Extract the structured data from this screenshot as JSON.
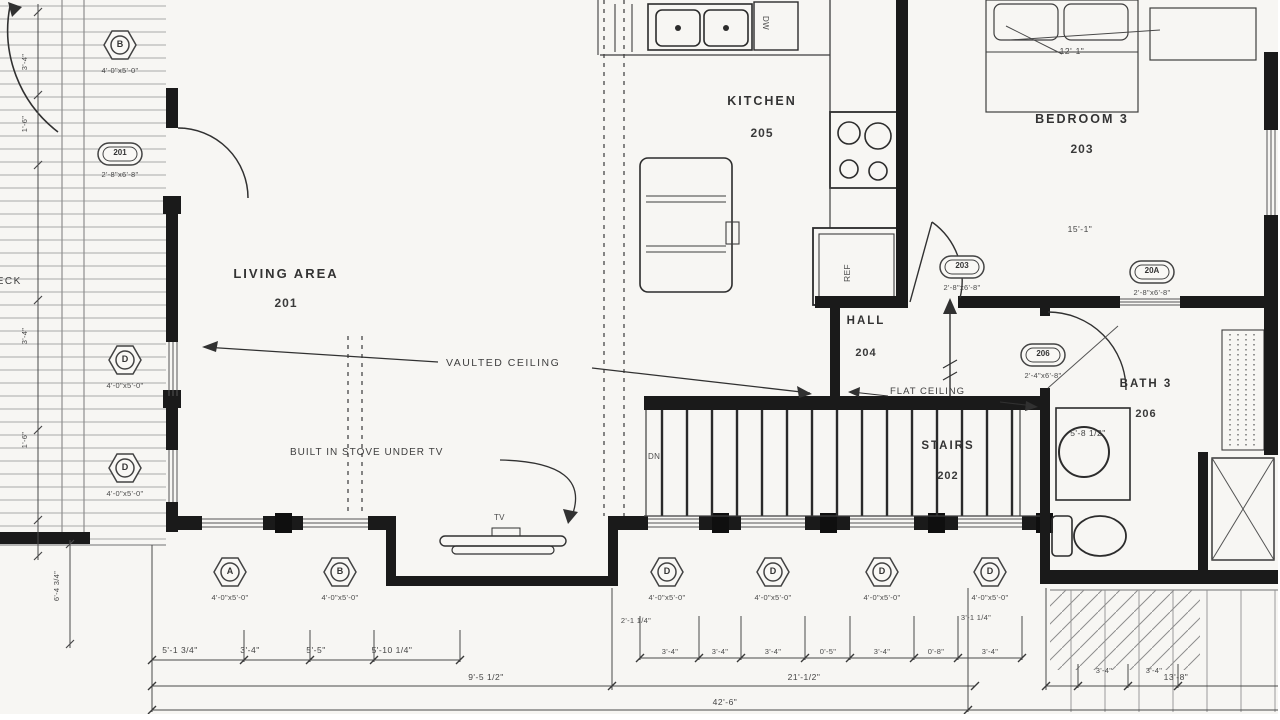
{
  "colors": {
    "paper": "#f7f6f3",
    "wall": "#1c1c1c",
    "line_dark": "#3f3f3f",
    "line_light": "#9a9a9a",
    "text": "#3a3a3a"
  },
  "rooms": {
    "living": {
      "name": "LIVING AREA",
      "number": "201"
    },
    "kitchen": {
      "name": "KITCHEN",
      "number": "205"
    },
    "bedroom3": {
      "name": "BEDROOM 3",
      "number": "203"
    },
    "hall": {
      "name": "HALL",
      "number": "204"
    },
    "stairs": {
      "name": "STAIRS",
      "number": "202"
    },
    "bath3": {
      "name": "BATH 3",
      "number": "206"
    }
  },
  "annotations": {
    "vaulted": "VAULTED CEILING",
    "flat": "FLAT CEILING",
    "built_in": "BUILT IN STOVE UNDER TV",
    "tv": "TV",
    "dw": "DW",
    "ref": "REF",
    "dn": "DN",
    "deck": "DECK"
  },
  "window_tags": [
    {
      "letter": "B",
      "size": "4'-0\"x5'-0\""
    },
    {
      "letter": "D",
      "size": "4'-0\"x5'-0\""
    },
    {
      "letter": "D",
      "size": "4'-0\"x5'-0\""
    },
    {
      "letter": "A",
      "size": "4'-0\"x5'-0\""
    },
    {
      "letter": "B",
      "size": "4'-0\"x5'-0\""
    },
    {
      "letter": "D",
      "size": "4'-0\"x5'-0\""
    },
    {
      "letter": "D",
      "size": "4'-0\"x5'-0\""
    },
    {
      "letter": "D",
      "size": "4'-0\"x5'-0\""
    },
    {
      "letter": "D",
      "size": "4'-0\"x5'-0\""
    }
  ],
  "door_tags": [
    {
      "num": "201",
      "size": "2'-8\"x6'-8\""
    },
    {
      "num": "203",
      "size": "2'-8\"x6'-8\""
    },
    {
      "num": "20A",
      "size": "2'-8\"x6'-8\""
    },
    {
      "num": "206",
      "size": "2'-4\"x6'-8\""
    }
  ],
  "dims": [
    "5'-1 3/4\"",
    "3'-4\"",
    "5'-5\"",
    "5'-10 1/4\"",
    "9'-5 1/2\"",
    "42'-6\"",
    "21'-1/2\"",
    "13'-8\"",
    "2'-1 1/4\"",
    "3'-1 1/4\"",
    "3'-4\"",
    "3'-4\"",
    "3'-4\"",
    "0'-5\"",
    "3'-4\"",
    "0'-8\"",
    "3'-4\"",
    "12'-1\"",
    "15'-1\"",
    "5'-8 1/2\"",
    "3'-4\"",
    "3'-4\"",
    "6'-4 3/4\"",
    "1'-6\"",
    "3'-4\"",
    "1'-6\"",
    "3'-4\""
  ]
}
